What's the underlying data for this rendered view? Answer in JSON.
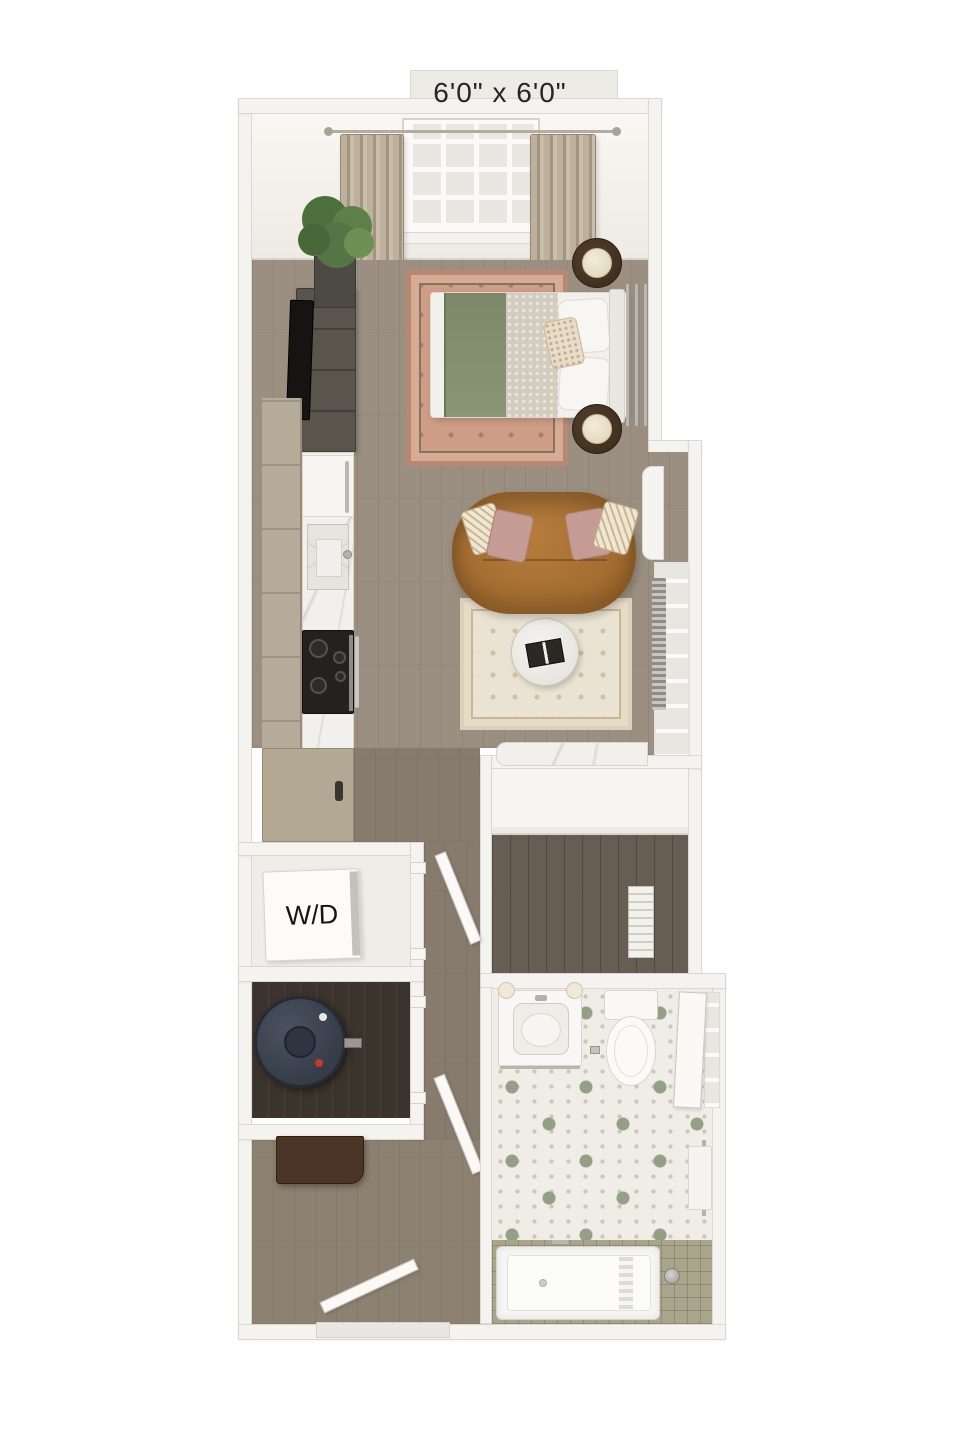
{
  "floorplan": {
    "patio_dimension_label": "6'0\" x 6'0\"",
    "washer_dryer_label": "W/D",
    "rooms": [
      "patio",
      "sleeping-area",
      "kitchen",
      "living-area",
      "hallway",
      "walk-in-closet",
      "washer-dryer-closet",
      "utility-closet",
      "entry",
      "bathroom"
    ],
    "fixtures": [
      "window",
      "curtains",
      "potted-plant",
      "media-console",
      "tv",
      "bed",
      "green-blanket",
      "nightstands",
      "table-lamps",
      "bedroom-rug",
      "refrigerator",
      "kitchen-sink",
      "cooktop-range",
      "cabinets",
      "sofa",
      "throw-pillows",
      "coffee-table",
      "living-rug",
      "window-radiator",
      "built-in-desk",
      "closet-shelf",
      "washer-dryer-unit",
      "water-heater",
      "entry-console",
      "entry-door",
      "bathroom-vanity",
      "vanity-sconces",
      "toilet",
      "towel-bar",
      "bathtub",
      "shower-head",
      "hex-tile-floor"
    ],
    "colors": {
      "background": "#ffffff",
      "wall": "#f5f3ef",
      "wall_edge": "#dcd8d0",
      "wood_floor": "#9a8f80",
      "hall_floor": "#867b6c",
      "entry_floor": "#8d8172",
      "closet_floor": "#675e53",
      "utility_floor": "#3b342c",
      "cabinet_tan": "#b5ab98",
      "counter_marble": "#f1f0ec",
      "cooktop_black": "#242220",
      "sofa_caramel": "#ab7436",
      "pillow_pink": "#c59c93",
      "pillow_cream": "#efe7d2",
      "living_rug": "#eae3d3",
      "bedroom_rug": "#cf9d85",
      "blanket_sage": "#81906f",
      "bedding_white": "#f2f0ec",
      "nightstand_brown": "#4e3b2b",
      "plant_green": "#567546",
      "dresser_gray": "#5a554c",
      "water_heater_navy": "#3f4754",
      "console_brown": "#4a3526",
      "hex_tile": "#efede6",
      "hex_accent": "#94a086",
      "tub_tile_olive": "#a9a58b",
      "fixture_white": "#f8f7f5",
      "label_text": "#262626"
    }
  }
}
